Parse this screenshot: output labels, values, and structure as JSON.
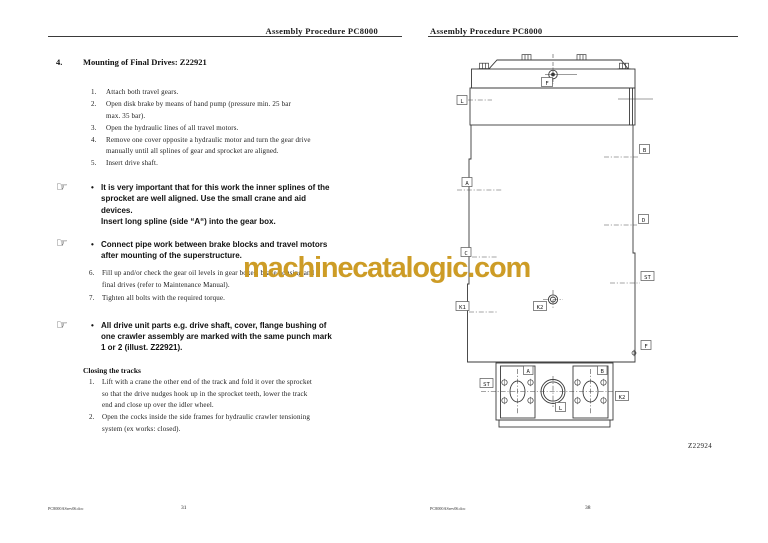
{
  "icons": {
    "pointing_hand": "☞"
  },
  "watermark": {
    "text": "machinecatalogic.com",
    "color": "#CB991E"
  },
  "left_page": {
    "header": "Assembly Procedure PC8000",
    "section_number": "4.",
    "section_title": "Mounting of Final Drives: Z22921",
    "steps_a": [
      {
        "num": "1.",
        "text": "Attach both travel gears."
      },
      {
        "num": "2.",
        "text": "Open disk brake by means of hand pump (pressure min. 25 bar\nmax. 35 bar)."
      },
      {
        "num": "3.",
        "text": "Open the hydraulic lines of all travel motors."
      },
      {
        "num": "4.",
        "text": "Remove one cover opposite a hydraulic motor and turn the gear drive\nmanually until all splines of gear and sprocket are aligned."
      },
      {
        "num": "5.",
        "text": "Insert drive shaft."
      }
    ],
    "notes": [
      {
        "bullet": "•",
        "text": "It is very important that for this work the inner splines of the\nsprocket are well aligned. Use the small crane and aid\ndevices.\nInsert long spline (side “A“) into the gear box."
      },
      {
        "bullet": "•",
        "text": "Connect pipe work between brake blocks and travel motors\nafter mounting of the superstructure."
      },
      {
        "bullet": "•",
        "text": "All drive unit parts e.g. drive shaft, cover, flange bushing of\none crawler assembly are marked with the same punch mark\n1 or 2 (illust. Z22921)."
      }
    ],
    "steps_b": [
      {
        "num": "6.",
        "text": "Fill up and/or check the gear oil levels in gear boxes, brake housing and\nfinal drives (refer to Maintenance Manual)."
      },
      {
        "num": "7.",
        "text": "Tighten all bolts with the required torque."
      }
    ],
    "closing_heading": "Closing the tracks",
    "closing_steps": [
      {
        "num": "1.",
        "text": "Lift with a crane the other end of the track and fold it over the sprocket\nso that the drive nudges hook up in the sprocket teeth, lower the track\nend and close up over the idler wheel."
      },
      {
        "num": "2.",
        "text": "Open the cocks inside the side frames for hydraulic crawler tensioning\nsystem (ex works: closed)."
      }
    ],
    "footer_doc": "PC8000ASrev06.doc",
    "footer_page": "31"
  },
  "right_page": {
    "header": "Assembly Procedure PC8000",
    "figure_code": "Z22924",
    "footer_doc": "PC8000ASrev06.doc",
    "footer_page": "38"
  },
  "diagram": {
    "side_labels": {
      "F": "F",
      "L": "L",
      "B": "B",
      "A": "A",
      "D": "D",
      "C": "C",
      "ST": "ST",
      "K1": "K1",
      "K2": "K2"
    },
    "bottom_labels": {
      "A": "A",
      "B": "B",
      "ST": "ST",
      "K2": "K2",
      "L": "L",
      "F": "F"
    }
  }
}
